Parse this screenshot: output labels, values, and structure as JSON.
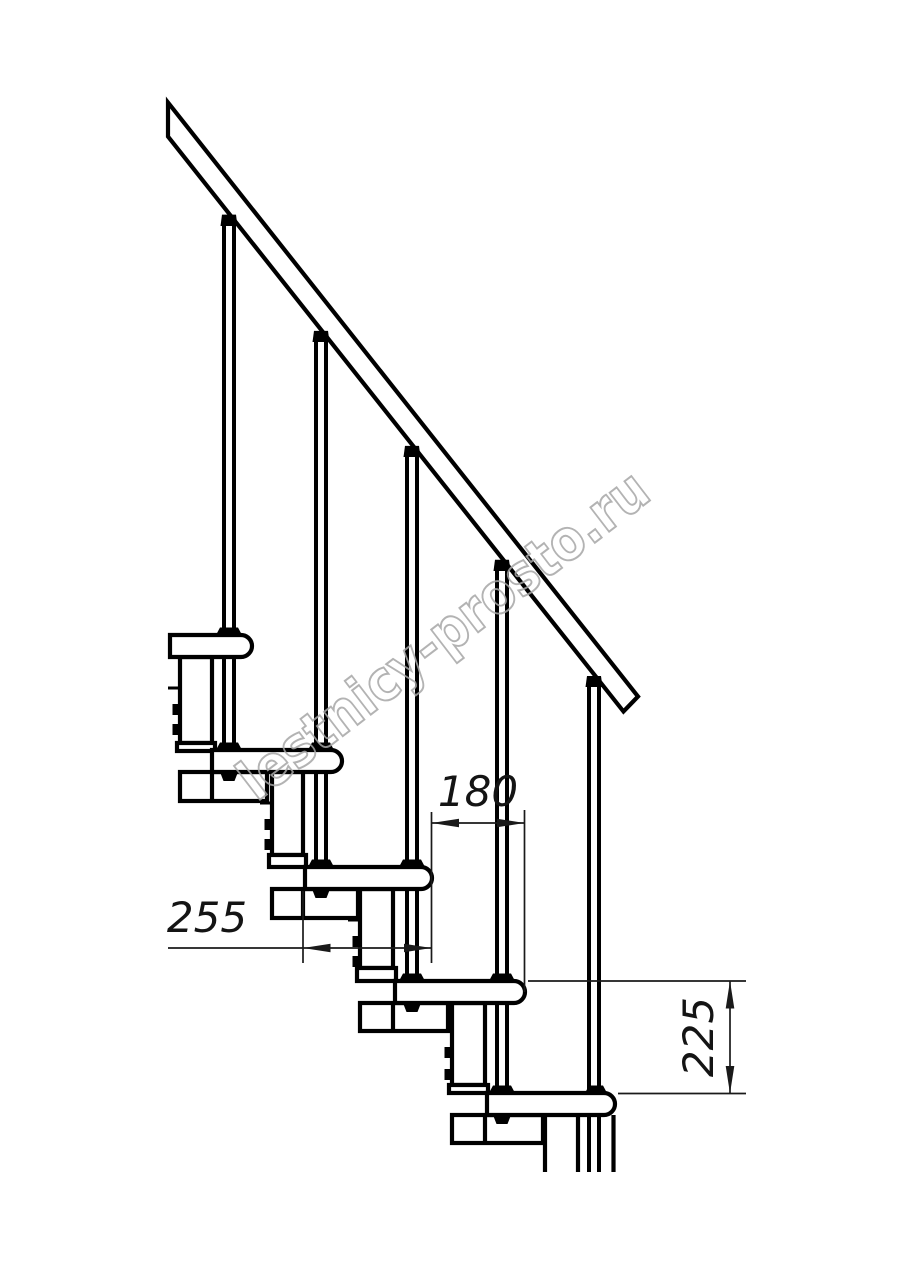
{
  "page": {
    "background": "#ffffff"
  },
  "drawing": {
    "line_color": "#000000",
    "dimension_color": "#1a1a1a",
    "watermark": {
      "text": "lestnicy-prosto.ru",
      "color": "#a6a6a6",
      "rotation_deg": -37.5
    },
    "dimensions": [
      {
        "name": "step-going",
        "label": "180",
        "value": 180,
        "orientation": "horizontal"
      },
      {
        "name": "tread-depth",
        "label": "255",
        "value": 255,
        "orientation": "horizontal"
      },
      {
        "name": "riser-height",
        "label": "225",
        "value": 225,
        "orientation": "vertical"
      }
    ],
    "components": {
      "treads": 5,
      "balusters": 5,
      "support_columns": 5,
      "handrail": true
    }
  }
}
